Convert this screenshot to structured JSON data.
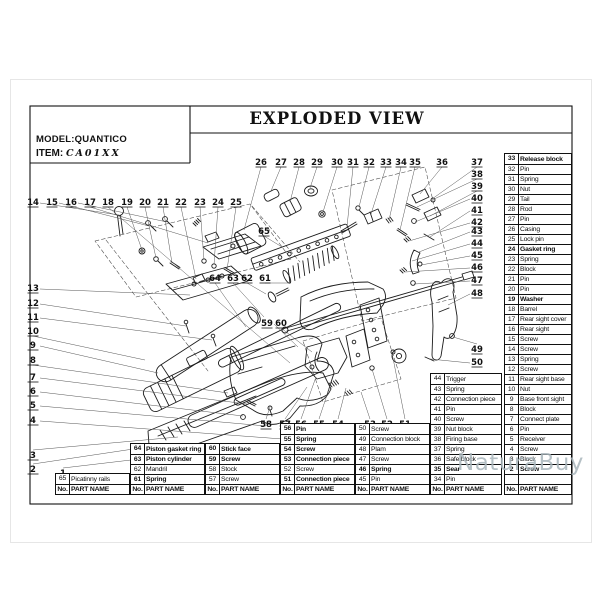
{
  "header": {
    "title": "EXPLODED VIEW",
    "model_label": "MODEL:",
    "model_value": "QUANTICO",
    "item_label": "ITEM:",
    "item_value": "CA01XX"
  },
  "labels": {
    "no": "No.",
    "part_name": "PART NAME"
  },
  "watermark": {
    "text": "NaturaBuy",
    "color": "#a9b6bc"
  },
  "tables": [
    {
      "name": "picatinny-rail-table",
      "rows": [
        {
          "no": "65",
          "name": "Picatinny rails",
          "bold": false
        }
      ]
    },
    {
      "name": "piston-group-table",
      "rows": [
        {
          "no": "64",
          "name": "Piston gasket ring",
          "bold": true
        },
        {
          "no": "63",
          "name": "Piston cylinder",
          "bold": true
        },
        {
          "no": "62",
          "name": "Mandril",
          "bold": false
        },
        {
          "no": "61",
          "name": "Spring",
          "bold": true
        }
      ]
    },
    {
      "name": "stock-group-table",
      "rows": [
        {
          "no": "60",
          "name": "Stick face",
          "bold": true
        },
        {
          "no": "59",
          "name": "Screw",
          "bold": true
        },
        {
          "no": "58",
          "name": "Stock",
          "bold": false
        },
        {
          "no": "57",
          "name": "Screw",
          "bold": false
        }
      ]
    },
    {
      "name": "connection-group-table",
      "rows": [
        {
          "no": "56",
          "name": "Pin",
          "bold": true
        },
        {
          "no": "55",
          "name": "Spring",
          "bold": true
        },
        {
          "no": "54",
          "name": "Screw",
          "bold": true
        },
        {
          "no": "53",
          "name": "Connection piece",
          "bold": true
        },
        {
          "no": "52",
          "name": "Screw",
          "bold": false
        },
        {
          "no": "51",
          "name": "Connection piece",
          "bold": true
        }
      ]
    },
    {
      "name": "link-group-table",
      "rows": [
        {
          "no": "50",
          "name": "Screw",
          "bold": false
        },
        {
          "no": "49",
          "name": "Connection block",
          "bold": false
        },
        {
          "no": "48",
          "name": "Plam",
          "bold": false
        },
        {
          "no": "47",
          "name": "Screw",
          "bold": false
        },
        {
          "no": "46",
          "name": "Spring",
          "bold": true
        },
        {
          "no": "45",
          "name": "Pin",
          "bold": false
        }
      ]
    },
    {
      "name": "trigger-group-table",
      "rows": [
        {
          "no": "44",
          "name": "Trigger",
          "bold": false
        },
        {
          "no": "43",
          "name": "Spring",
          "bold": false
        },
        {
          "no": "42",
          "name": "Connection piece",
          "bold": false
        },
        {
          "no": "41",
          "name": "Pin",
          "bold": false
        },
        {
          "no": "40",
          "name": "Screw",
          "bold": false
        },
        {
          "no": "39",
          "name": "Nut block",
          "bold": false
        },
        {
          "no": "38",
          "name": "Firing base",
          "bold": false
        },
        {
          "no": "37",
          "name": "Spring",
          "bold": false
        },
        {
          "no": "36",
          "name": "Safe block",
          "bold": false
        },
        {
          "no": "35",
          "name": "Sear",
          "bold": true
        },
        {
          "no": "34",
          "name": "Pin",
          "bold": false
        }
      ]
    },
    {
      "name": "main-parts-table",
      "rows": [
        {
          "no": "33",
          "name": "Release block",
          "bold": true
        },
        {
          "no": "32",
          "name": "Pin",
          "bold": false
        },
        {
          "no": "31",
          "name": "Spring",
          "bold": false
        },
        {
          "no": "30",
          "name": "Nut",
          "bold": false
        },
        {
          "no": "29",
          "name": "Tail",
          "bold": false
        },
        {
          "no": "28",
          "name": "Rod",
          "bold": false
        },
        {
          "no": "27",
          "name": "Pin",
          "bold": false
        },
        {
          "no": "26",
          "name": "Casing",
          "bold": false
        },
        {
          "no": "25",
          "name": "Lock pin",
          "bold": false
        },
        {
          "no": "24",
          "name": "Gasket ring",
          "bold": true
        },
        {
          "no": "23",
          "name": "Spring",
          "bold": false
        },
        {
          "no": "22",
          "name": "Block",
          "bold": false
        },
        {
          "no": "21",
          "name": "Pin",
          "bold": false
        },
        {
          "no": "20",
          "name": "Pin",
          "bold": false
        },
        {
          "no": "19",
          "name": "Washer",
          "bold": true
        },
        {
          "no": "18",
          "name": "Barrel",
          "bold": false
        },
        {
          "no": "17",
          "name": "Rear sight cover",
          "bold": false
        },
        {
          "no": "16",
          "name": "Rear sight",
          "bold": false
        },
        {
          "no": "15",
          "name": "Screw",
          "bold": false
        },
        {
          "no": "14",
          "name": "Screw",
          "bold": false
        },
        {
          "no": "13",
          "name": "Spring",
          "bold": false
        },
        {
          "no": "12",
          "name": "Screw",
          "bold": false
        },
        {
          "no": "11",
          "name": "Rear sight base",
          "bold": false
        },
        {
          "no": "10",
          "name": "Nut",
          "bold": false
        },
        {
          "no": "9",
          "name": "Base front sight",
          "bold": false
        },
        {
          "no": "8",
          "name": "Block",
          "bold": false
        },
        {
          "no": "7",
          "name": "Connect plate",
          "bold": false
        },
        {
          "no": "6",
          "name": "Pin",
          "bold": false
        },
        {
          "no": "5",
          "name": "Receiver",
          "bold": false
        },
        {
          "no": "4",
          "name": "Screw",
          "bold": false
        },
        {
          "no": "3",
          "name": "Block",
          "bold": false
        },
        {
          "no": "2",
          "name": "Screw",
          "bold": true
        },
        {
          "no": "",
          "name": "",
          "bold": false
        }
      ]
    }
  ],
  "diagram": {
    "callouts": [
      {
        "n": "14",
        "x": 33,
        "y": 205,
        "ex": 119,
        "ey": 215
      },
      {
        "n": "15",
        "x": 52,
        "y": 205,
        "ex": 149,
        "ey": 226
      },
      {
        "n": "16",
        "x": 71,
        "y": 205,
        "ex": 167,
        "ey": 222
      },
      {
        "n": "17",
        "x": 90,
        "y": 205,
        "ex": 208,
        "ey": 243
      },
      {
        "n": "18",
        "x": 108,
        "y": 205,
        "ex": 290,
        "ey": 363
      },
      {
        "n": "19",
        "x": 127,
        "y": 205,
        "ex": 142,
        "ey": 250
      },
      {
        "n": "20",
        "x": 145,
        "y": 205,
        "ex": 156,
        "ey": 258
      },
      {
        "n": "21",
        "x": 163,
        "y": 205,
        "ex": 172,
        "ey": 263
      },
      {
        "n": "22",
        "x": 181,
        "y": 205,
        "ex": 196,
        "ey": 279
      },
      {
        "n": "23",
        "x": 200,
        "y": 205,
        "ex": 204,
        "ey": 260
      },
      {
        "n": "24",
        "x": 218,
        "y": 205,
        "ex": 214,
        "ey": 265
      },
      {
        "n": "25",
        "x": 236,
        "y": 205,
        "ex": 227,
        "ey": 270
      },
      {
        "n": "26",
        "x": 261,
        "y": 165,
        "ex": 244,
        "ey": 230
      },
      {
        "n": "27",
        "x": 281,
        "y": 165,
        "ex": 271,
        "ey": 191
      },
      {
        "n": "28",
        "x": 299,
        "y": 165,
        "ex": 290,
        "ey": 202
      },
      {
        "n": "29",
        "x": 317,
        "y": 165,
        "ex": 310,
        "ey": 188
      },
      {
        "n": "30",
        "x": 337,
        "y": 165,
        "ex": 323,
        "ey": 212
      },
      {
        "n": "31",
        "x": 353,
        "y": 165,
        "ex": 347,
        "ey": 227
      },
      {
        "n": "32",
        "x": 369,
        "y": 165,
        "ex": 359,
        "ey": 207
      },
      {
        "n": "33",
        "x": 386,
        "y": 165,
        "ex": 371,
        "ey": 214
      },
      {
        "n": "34",
        "x": 401,
        "y": 165,
        "ex": 389,
        "ey": 220
      },
      {
        "n": "35",
        "x": 415,
        "y": 165,
        "ex": 400,
        "ey": 230
      },
      {
        "n": "36",
        "x": 442,
        "y": 165,
        "ex": 420,
        "ey": 194
      },
      {
        "n": "37",
        "x": 477,
        "y": 165,
        "ex": 432,
        "ey": 199
      },
      {
        "n": "38",
        "x": 477,
        "y": 177,
        "ex": 417,
        "ey": 207
      },
      {
        "n": "39",
        "x": 477,
        "y": 189,
        "ex": 430,
        "ey": 216
      },
      {
        "n": "40",
        "x": 477,
        "y": 201,
        "ex": 415,
        "ey": 222
      },
      {
        "n": "41",
        "x": 477,
        "y": 213,
        "ex": 430,
        "ey": 237
      },
      {
        "n": "42",
        "x": 477,
        "y": 225,
        "ex": 409,
        "ey": 241
      },
      {
        "n": "43",
        "x": 477,
        "y": 234,
        "ex": 419,
        "ey": 252
      },
      {
        "n": "44",
        "x": 477,
        "y": 246,
        "ex": 412,
        "ey": 261
      },
      {
        "n": "45",
        "x": 477,
        "y": 258,
        "ex": 421,
        "ey": 265
      },
      {
        "n": "46",
        "x": 477,
        "y": 270,
        "ex": 405,
        "ey": 272
      },
      {
        "n": "47",
        "x": 477,
        "y": 283,
        "ex": 414,
        "ey": 284
      },
      {
        "n": "48",
        "x": 477,
        "y": 296,
        "ex": 448,
        "ey": 305
      },
      {
        "n": "49",
        "x": 477,
        "y": 352,
        "ex": 453,
        "ey": 337
      },
      {
        "n": "50",
        "x": 477,
        "y": 365,
        "ex": 430,
        "ey": 359
      },
      {
        "n": "13",
        "x": 33,
        "y": 291,
        "ex": 190,
        "ey": 295
      },
      {
        "n": "12",
        "x": 33,
        "y": 306,
        "ex": 186,
        "ey": 326
      },
      {
        "n": "11",
        "x": 33,
        "y": 320,
        "ex": 212,
        "ey": 340
      },
      {
        "n": "10",
        "x": 33,
        "y": 334,
        "ex": 145,
        "ey": 360
      },
      {
        "n": "9",
        "x": 33,
        "y": 348,
        "ex": 158,
        "ey": 373
      },
      {
        "n": "8",
        "x": 33,
        "y": 363,
        "ex": 228,
        "ey": 393
      },
      {
        "n": "7",
        "x": 33,
        "y": 380,
        "ex": 247,
        "ey": 404
      },
      {
        "n": "6",
        "x": 33,
        "y": 394,
        "ex": 243,
        "ey": 416
      },
      {
        "n": "5",
        "x": 33,
        "y": 408,
        "ex": 266,
        "ey": 426
      },
      {
        "n": "4",
        "x": 33,
        "y": 423,
        "ex": 296,
        "ey": 440
      },
      {
        "n": "3",
        "x": 33,
        "y": 458,
        "ex": 178,
        "ey": 437
      },
      {
        "n": "2",
        "x": 33,
        "y": 472,
        "ex": 140,
        "ey": 448
      },
      {
        "n": "1",
        "x": 63,
        "y": 476,
        "ex": 148,
        "ey": 458
      },
      {
        "n": "65",
        "x": 264,
        "y": 234,
        "ex": 282,
        "ey": 247
      },
      {
        "n": "64",
        "x": 215,
        "y": 281,
        "ex": 246,
        "ey": 327
      },
      {
        "n": "63",
        "x": 233,
        "y": 281,
        "ex": 264,
        "ey": 317
      },
      {
        "n": "62",
        "x": 247,
        "y": 281,
        "ex": 266,
        "ey": 294
      },
      {
        "n": "61",
        "x": 265,
        "y": 281,
        "ex": 290,
        "ey": 283
      },
      {
        "n": "59",
        "x": 267,
        "y": 326,
        "ex": 298,
        "ey": 347
      },
      {
        "n": "60",
        "x": 281,
        "y": 326,
        "ex": 312,
        "ey": 352
      },
      {
        "n": "58",
        "x": 266,
        "y": 427,
        "ex": 270,
        "ey": 407
      },
      {
        "n": "57",
        "x": 285,
        "y": 427,
        "ex": 307,
        "ey": 387
      },
      {
        "n": "56",
        "x": 301,
        "y": 427,
        "ex": 316,
        "ey": 377
      },
      {
        "n": "55",
        "x": 319,
        "y": 427,
        "ex": 331,
        "ey": 383
      },
      {
        "n": "54",
        "x": 338,
        "y": 427,
        "ex": 346,
        "ey": 388
      },
      {
        "n": "53",
        "x": 370,
        "y": 427,
        "ex": 361,
        "ey": 392
      },
      {
        "n": "52",
        "x": 387,
        "y": 427,
        "ex": 372,
        "ey": 369
      },
      {
        "n": "51",
        "x": 405,
        "y": 427,
        "ex": 392,
        "ey": 353
      }
    ]
  }
}
